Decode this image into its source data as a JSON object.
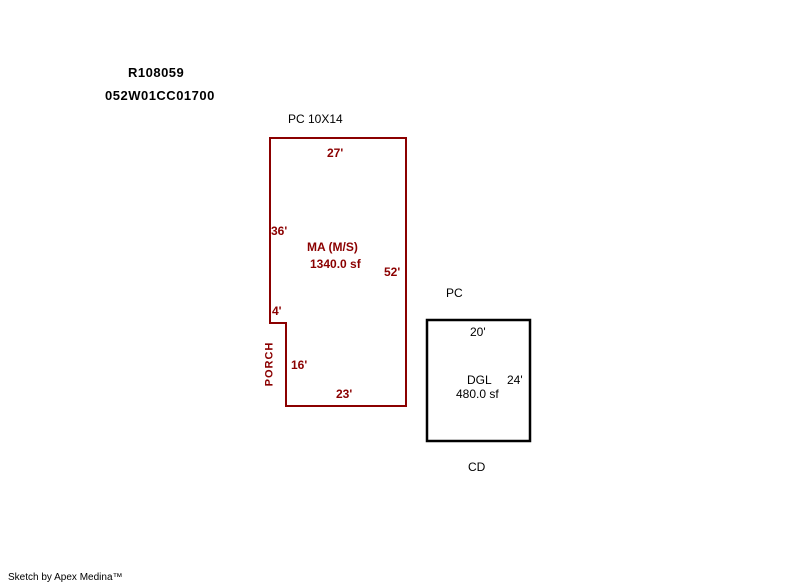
{
  "colors": {
    "outline_main": "#8B0000",
    "outline_secondary": "#000000",
    "label_dark": "#000000",
    "background": "#FFFFFF"
  },
  "header": {
    "record_id": "R108059",
    "parcel_id": "052W01CC01700",
    "pc_note": "PC 10X14"
  },
  "main_building": {
    "name": "MA (M/S)",
    "area": "1340.0 sf",
    "porch": "PORCH",
    "dim_top": "27'",
    "dim_left_upper": "36'",
    "dim_right": "52'",
    "dim_notch": "4'",
    "dim_porch_side": "16'",
    "dim_bottom": "23'"
  },
  "second_building": {
    "top_note": "PC",
    "name": "DGL",
    "area": "480.0 sf",
    "bottom_note": "CD",
    "dim_top": "20'",
    "dim_right": "24'"
  },
  "footer": {
    "credit": "Sketch by Apex Medina™"
  }
}
